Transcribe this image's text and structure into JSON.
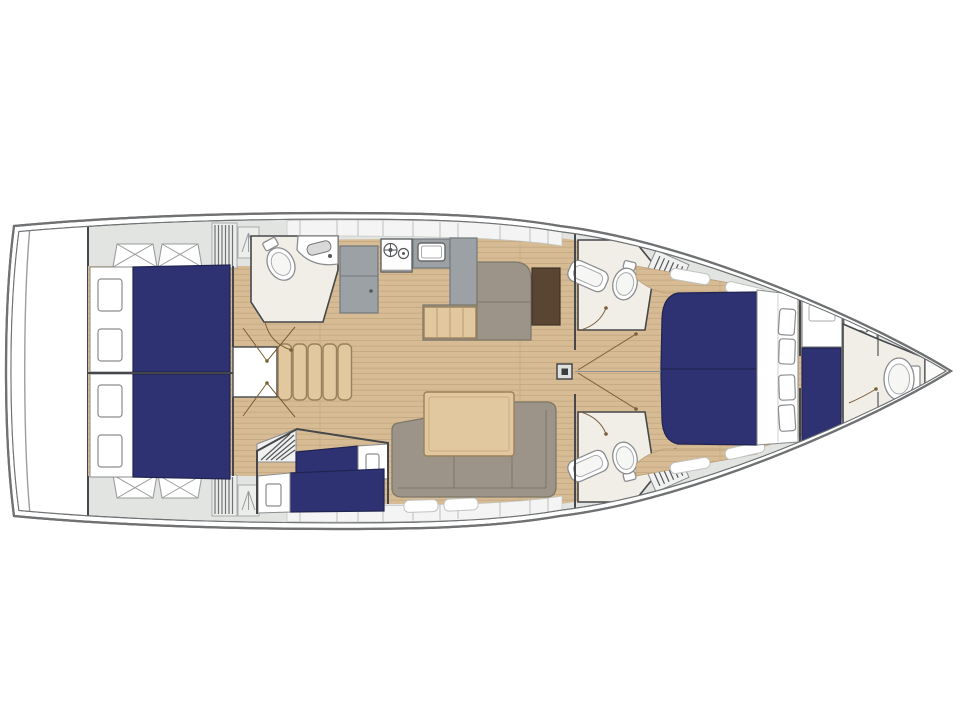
{
  "image": {
    "width": 960,
    "height": 720,
    "background": "#ffffff",
    "description": "Top-down interior layout plan of a sailing yacht, bow pointing right"
  },
  "colors": {
    "background": "#ffffff",
    "hull_stroke": "#6f7173",
    "line": "#45474a",
    "deck": "#e2e4e2",
    "panel": "#f3f4f3",
    "wood": "#d6bb95",
    "wood_line": "#c2a67d",
    "table_wood": "#e2c89f",
    "sofa": "#9c9488",
    "sofa_dark": "#7e7869",
    "counter": "#9ba1a4",
    "counter_dark": "#72787b",
    "bed_navy": "#2e3273",
    "bed_navy_dark": "#20244f",
    "room_floor": "#f1eee7",
    "fixture_stroke": "#8a8c8e",
    "door": "#7c5f3c",
    "chart_table": "#5a4533"
  },
  "vessel": {
    "orientation": "bow-right",
    "berth_color": "#2e3273",
    "areas": [
      {
        "name": "swim-platform"
      },
      {
        "name": "aft-cabin-port",
        "features": [
          "double-berth",
          "two-pillows",
          "deck-hatches"
        ]
      },
      {
        "name": "aft-cabin-starboard",
        "features": [
          "double-berth",
          "two-pillows",
          "deck-hatches"
        ]
      },
      {
        "name": "aft-head",
        "features": [
          "toilet",
          "sink-counter",
          "door"
        ]
      },
      {
        "name": "companionway-steps",
        "features": [
          "five-treads",
          "engine-box"
        ]
      },
      {
        "name": "galley",
        "features": [
          "refrigerator",
          "two-burner-stove",
          "sink",
          "counter"
        ]
      },
      {
        "name": "dinette-sofa",
        "features": [
          "l-shape",
          "wood-bench",
          "chart-table"
        ]
      },
      {
        "name": "saloon-sofa",
        "features": [
          "l-shape",
          "wood-table"
        ]
      },
      {
        "name": "bunk-cabin",
        "features": [
          "two-single-berths",
          "louver-steps"
        ]
      },
      {
        "name": "mast-step"
      },
      {
        "name": "forward-head-port",
        "features": [
          "toilet",
          "sink",
          "grate"
        ]
      },
      {
        "name": "forward-head-starboard",
        "features": [
          "toilet",
          "sink",
          "grate"
        ]
      },
      {
        "name": "owner-cabin",
        "features": [
          "double-berth",
          "four-pillows",
          "side-shelves",
          "hull-windows"
        ]
      },
      {
        "name": "bow-cabin",
        "features": [
          "single-berth",
          "wardrobe",
          "sink"
        ]
      },
      {
        "name": "bow-head",
        "features": [
          "toilet",
          "tank"
        ]
      }
    ]
  }
}
